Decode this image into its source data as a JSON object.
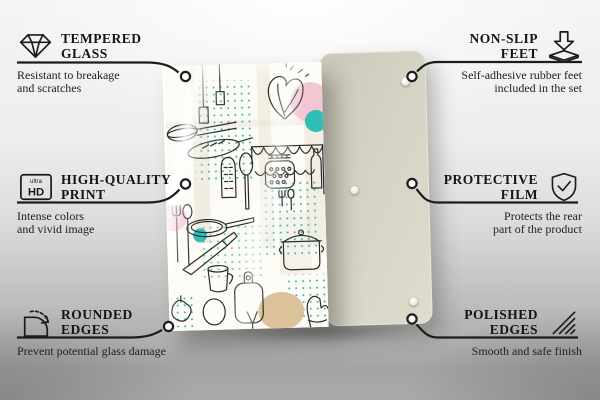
{
  "colors": {
    "leader_line": "#1c1c1c",
    "background_top": "#f3f3f2",
    "background_bottom": "#a5a4a3",
    "back_panel": "#d5d3c4",
    "glass_background": "#fcfbf6",
    "doodle_line": "#2b2b2b",
    "accent_teal": "#2fbdb6",
    "accent_pink": "#f3c6d3",
    "accent_tan": "#dcc29b"
  },
  "callouts": {
    "left": [
      {
        "icon": "diamond-icon",
        "title_lines": [
          "TEMPERED",
          "GLASS"
        ],
        "subtitle_lines": [
          "Resistant to breakage",
          "and scratches"
        ]
      },
      {
        "icon": "ultra-hd-icon",
        "icon_text": {
          "small": "ultra",
          "big": "HD"
        },
        "title_lines": [
          "HIGH-QUALITY",
          "PRINT"
        ],
        "subtitle_lines": [
          "Intense colors",
          "and vivid image"
        ]
      },
      {
        "icon": "rounded-corner-icon",
        "title_lines": [
          "ROUNDED",
          "EDGES"
        ],
        "subtitle_lines": [
          "Prevent potential glass damage"
        ]
      }
    ],
    "right": [
      {
        "icon": "non-slip-feet-icon",
        "title_lines": [
          "NON-SLIP",
          "FEET"
        ],
        "subtitle_lines": [
          "Self-adhesive rubber feet",
          "included in the set"
        ]
      },
      {
        "icon": "shield-check-icon",
        "title_lines": [
          "PROTECTIVE",
          "FILM"
        ],
        "subtitle_lines": [
          "Protects the rear",
          "part of the product"
        ]
      },
      {
        "icon": "polished-edges-icon",
        "title_lines": [
          "POLISHED",
          "EDGES"
        ],
        "subtitle_lines": [
          "Smooth and safe finish"
        ]
      }
    ]
  }
}
